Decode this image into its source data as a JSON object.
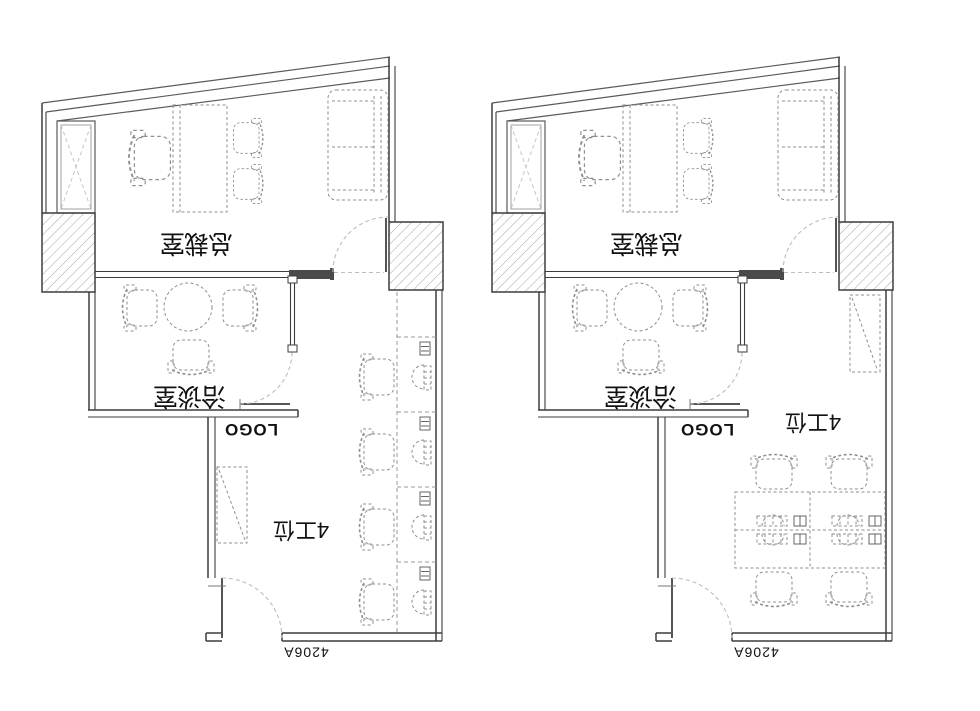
{
  "drawing_title": "office floor plan options",
  "colors": {
    "background": "#ffffff",
    "wall": "#3d3d3d",
    "furniture_dash": "#8f8f8f",
    "door_swing": "#bcbcbc",
    "hatch": "#9a9a9a",
    "text": "#111111"
  },
  "plans": [
    {
      "id": "plan-left",
      "ceo_office": "总裁室",
      "meeting_room": "洽谈室",
      "workstations": "4工位",
      "logo": "LOGO",
      "room_number": "4206A"
    },
    {
      "id": "plan-right",
      "ceo_office": "总裁室",
      "meeting_room": "洽谈室",
      "workstations": "4工位",
      "logo": "LOGO",
      "room_number": "4206A"
    }
  ]
}
